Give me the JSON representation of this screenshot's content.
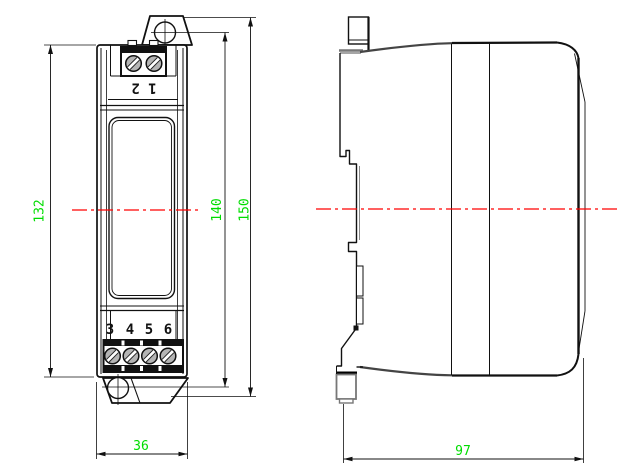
{
  "dimensions": {
    "front_body_height": "132",
    "front_hole_distance": "140",
    "front_overall_height": "150",
    "front_width": "36",
    "side_depth": "97"
  },
  "terminals": {
    "top_label": "1 2",
    "bottom_labels": [
      "3",
      "4",
      "5",
      "6"
    ]
  },
  "colors": {
    "dimension_text": "#00dd00",
    "centerline": "#ff0000"
  }
}
